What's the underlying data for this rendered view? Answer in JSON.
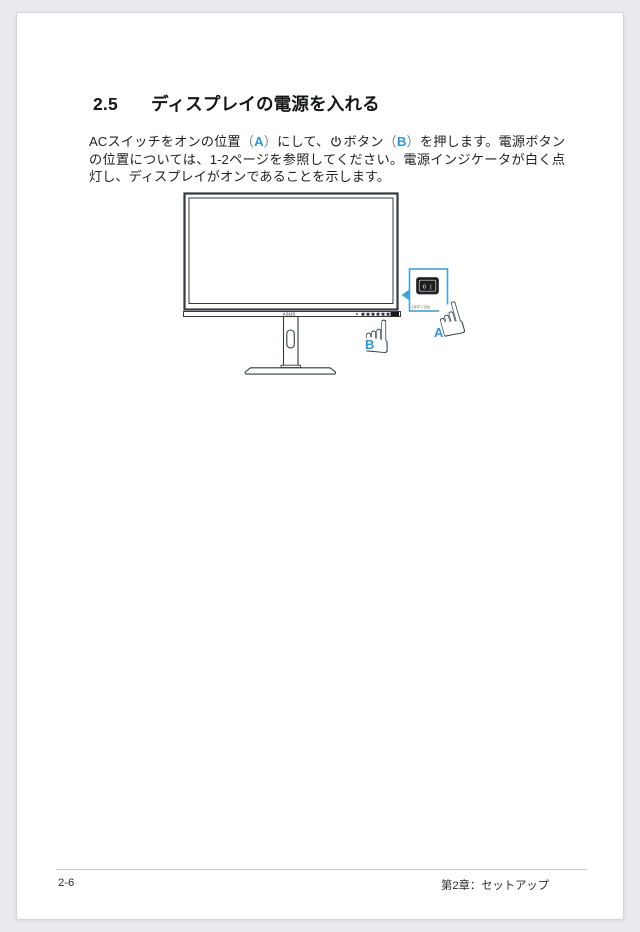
{
  "page": {
    "heading": {
      "number": "2.5",
      "title": "ディスプレイの電源を入れる"
    },
    "paragraph": {
      "p1": "ACスイッチをオンの位置",
      "paren_open_a": "（",
      "label_a": "A",
      "paren_close_a": "）",
      "p2": "にして、",
      "p3": "ボタン",
      "paren_open_b": "（",
      "label_b": "B",
      "paren_close_b": "）",
      "p4": "を押します。電源ボタンの位置については、1-2ページを参照してください。電源インジケータが白く点灯し、ディスプレイがオンであることを示します。"
    },
    "footer": {
      "page_number": "2-6",
      "chapter": "第2章：セットアップ"
    }
  },
  "figure": {
    "brand": "ASUS",
    "callout": {
      "switch_markings": "O |",
      "caption": "OFF / ON"
    },
    "labels": {
      "a": "A",
      "b": "B"
    },
    "hand_icon": "☝"
  },
  "colors": {
    "accent_blue": "#2e96d5",
    "callout_blue": "#41a2da",
    "line_dark": "#343a40"
  }
}
